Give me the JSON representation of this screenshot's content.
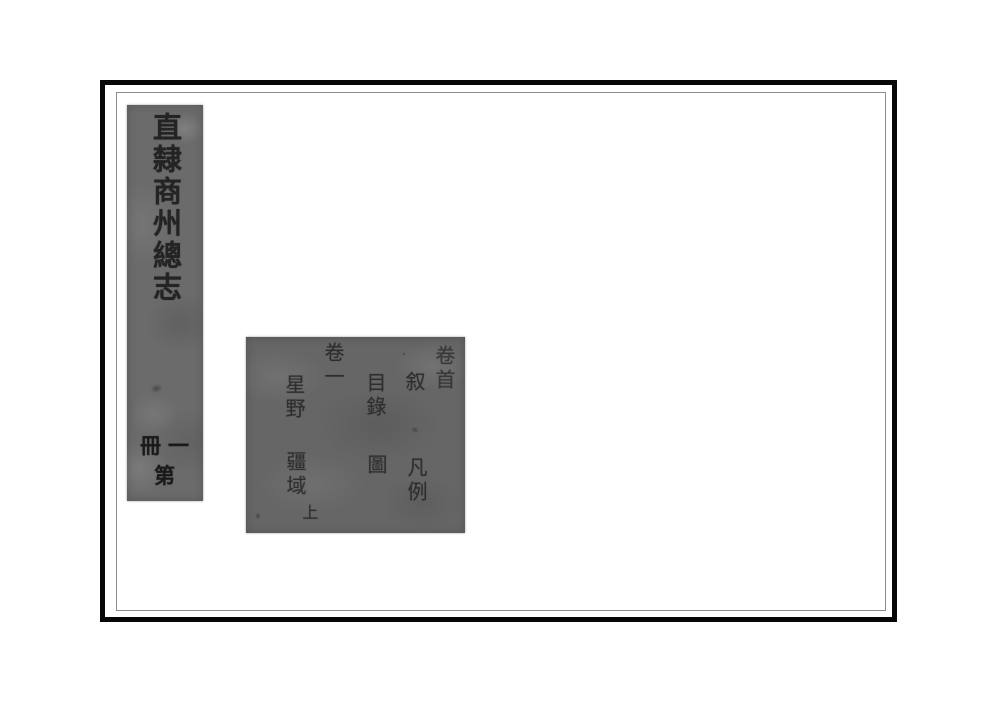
{
  "colors": {
    "page_background": "#ffffff",
    "frame_black": "#070707",
    "inner_rule_gray": "#8c8c8c",
    "spine_paper_gray": "#6b6b6b",
    "toc_paper_gray": "#666666",
    "ink": "#202020"
  },
  "spine": {
    "title": "直隸商州總志",
    "volume_label": "冊一第"
  },
  "toc_block": {
    "entries": [
      {
        "id": "juanshou",
        "text": "卷首"
      },
      {
        "id": "xu",
        "text": "叙"
      },
      {
        "id": "fanli",
        "text": "凡例"
      },
      {
        "id": "mulu",
        "text": "目錄"
      },
      {
        "id": "tu",
        "text": "圖"
      },
      {
        "id": "juanyi",
        "text": "卷一"
      },
      {
        "id": "xingye",
        "text": "星野"
      },
      {
        "id": "jiangyu",
        "text": "疆域"
      },
      {
        "id": "shang",
        "text": "上"
      }
    ]
  }
}
